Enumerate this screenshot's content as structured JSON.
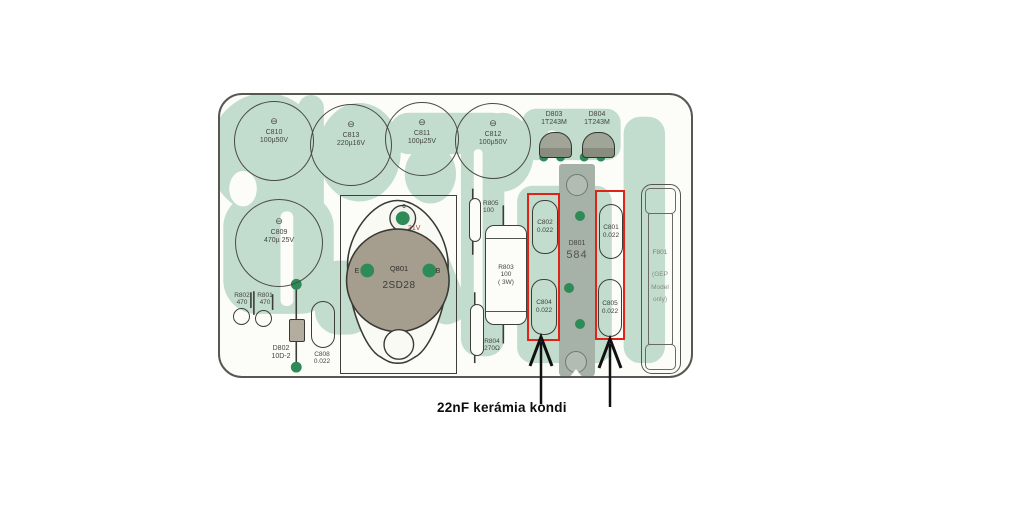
{
  "colors": {
    "trace_green": "#c2ddcd",
    "pad_green": "#2e8b57",
    "highlight_red": "#e02318",
    "strip_grey": "#a6b2a8"
  },
  "annotation": {
    "label": "22nF kerámia kondi"
  },
  "board": {
    "electrolytics": [
      {
        "ref": "C810",
        "value": "100µ50V",
        "polarity": "⊖"
      },
      {
        "ref": "C813",
        "value": "220µ16V",
        "polarity": "⊖"
      },
      {
        "ref": "C811",
        "value": "100µ25V",
        "polarity": "⊖"
      },
      {
        "ref": "C812",
        "value": "100µ50V",
        "polarity": "⊖"
      },
      {
        "ref": "C809",
        "value": "470µ 25V",
        "polarity": "⊖"
      }
    ],
    "ceramics": [
      {
        "ref": "C802",
        "value": "0.022"
      },
      {
        "ref": "C801",
        "value": "0.022"
      },
      {
        "ref": "C804",
        "value": "0.022"
      },
      {
        "ref": "C805",
        "value": "0.022"
      },
      {
        "ref": "C808",
        "value": "0.022"
      }
    ],
    "resistors": [
      {
        "ref": "R805",
        "value": "100"
      },
      {
        "ref": "R803",
        "value": "100",
        "power": "( 3W)"
      },
      {
        "ref": "R804",
        "value": "270Ω"
      },
      {
        "ref": "R802",
        "value": "470"
      },
      {
        "ref": "R801",
        "value": "470"
      }
    ],
    "diodes": [
      {
        "ref": "D803",
        "value": "1T243M"
      },
      {
        "ref": "D804",
        "value": "1T243M"
      },
      {
        "ref": "D801",
        "value": "584"
      },
      {
        "ref": "D802",
        "value": "10D-2"
      }
    ],
    "transistor": {
      "ref": "Q801",
      "part": "2SD28",
      "pin_c": "c",
      "pin_e": "E",
      "pin_b": "B",
      "voltage": "31V"
    },
    "fuse": {
      "ref": "F801",
      "line1": "(GEP",
      "line2": "Model",
      "line3": "only)"
    }
  }
}
